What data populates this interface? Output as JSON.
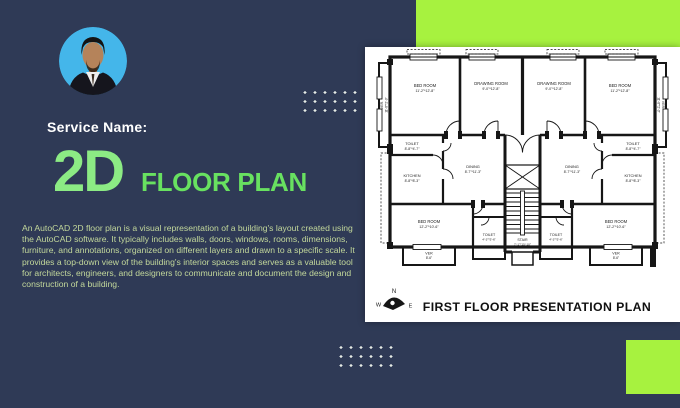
{
  "colors": {
    "background_navy": "#2f3a56",
    "accent_lime": "#a7f23f",
    "title_main_green": "#8ceb84",
    "title_sub_green": "#68e160",
    "body_text_green": "#c3d89b",
    "panel_white": "#ffffff",
    "plan_ink": "#161616"
  },
  "header": {
    "service_label": "Service Name:",
    "title_main": "2D",
    "title_sub": "FLOOR PLAN"
  },
  "description": {
    "text": "An AutoCAD 2D floor plan is a visual representation of a building's layout created using the AutoCAD software. It typically includes walls, doors, windows, rooms, dimensions, furniture, and annotations, organized on different layers and drawn to a specific scale. It provides a top-down view of the building's interior spaces and serves as a valuable tool for architects, engineers, and designers to communicate and document the design and construction of a building."
  },
  "floor_plan": {
    "title": "FIRST FLOOR PRESENTATION PLAN",
    "compass": {
      "north": "N",
      "west": "W",
      "east": "E"
    },
    "rooms": [
      {
        "name": "BED ROOM",
        "dims": "11'-2\"*12'-8\""
      },
      {
        "name": "DRAWING ROOM",
        "dims": "9'-0\"*12'-8\""
      },
      {
        "name": "DRAWING ROOM",
        "dims": "9'-0\"*12'-8\""
      },
      {
        "name": "BED ROOM",
        "dims": "11'-2\"*12'-8\""
      },
      {
        "name": "VER.",
        "dims": "11'-8\"*2'-9\""
      },
      {
        "name": "VER.",
        "dims": "11'-8\"*2'-9\""
      },
      {
        "name": "TOILET",
        "dims": "8'-8\"*4'-7\""
      },
      {
        "name": "TOILET",
        "dims": "8'-8\"*4'-7\""
      },
      {
        "name": "DINING",
        "dims": "8'-7\"*11'-3\""
      },
      {
        "name": "DINING",
        "dims": "8'-7\"*11'-3\""
      },
      {
        "name": "KITCHEN",
        "dims": "8'-8\"*8'-3\""
      },
      {
        "name": "KITCHEN",
        "dims": "8'-8\"*8'-3\""
      },
      {
        "name": "BED ROOM",
        "dims": "12'-2\"*10'-6\""
      },
      {
        "name": "BED ROOM",
        "dims": "12'-2\"*10'-6\""
      },
      {
        "name": "TOILET",
        "dims": "4'-3\"*5'-6\""
      },
      {
        "name": "TOILET",
        "dims": "4'-3\"*5'-6\""
      },
      {
        "name": "STAIR",
        "dims": "7'-1\"*15'-10\""
      },
      {
        "name": "VER",
        "dims": "8'-6\""
      },
      {
        "name": "VER",
        "dims": "8'-6\""
      }
    ]
  }
}
